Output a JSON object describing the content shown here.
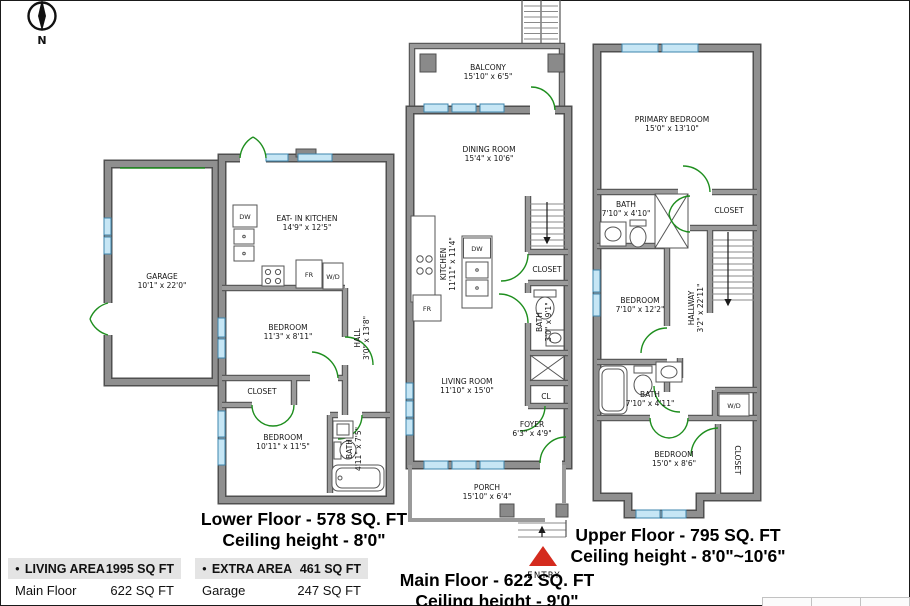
{
  "compass": {
    "label": "N"
  },
  "colors": {
    "wall": "#8f8f8f",
    "wall_edge": "#4f4f4f",
    "window": "#c6e6f5",
    "window_frame": "#3d85ad",
    "door": "#1e8e1e",
    "entry_marker": "#d42b1e",
    "table_header_bg": "#e4e4e4"
  },
  "floors": {
    "lower": {
      "caption1": "Lower Floor - 578 SQ. FT",
      "caption2": "Ceiling height - 8'0\"",
      "rooms": {
        "garage": {
          "name": "GARAGE",
          "dims": "10'1\" x 22'0\""
        },
        "kitchen": {
          "name": "EAT- IN KITCHEN",
          "dims": "14'9\" x 12'5\""
        },
        "bedroom1": {
          "name": "BEDROOM",
          "dims": "11'3\" x 8'11\""
        },
        "hall": {
          "name": "HALL",
          "dims": "3'0\" x 13'8\""
        },
        "closet": {
          "name": "CLOSET"
        },
        "bedroom2": {
          "name": "BEDROOM",
          "dims": "10'11\" x 11'5\""
        },
        "bath": {
          "name": "BATH",
          "dims": "4'11\" x 7'5\""
        }
      },
      "fixtures": {
        "dw": "DW",
        "fr": "FR",
        "wd": "W/D"
      }
    },
    "main": {
      "caption1": "Main Floor - 622 SQ. FT",
      "caption2": "Ceiling height - 9'0\"",
      "entry_label": "ENTRY",
      "rooms": {
        "balcony": {
          "name": "BALCONY",
          "dims": "15'10\" x 6'5\""
        },
        "dining": {
          "name": "DINING ROOM",
          "dims": "15'4\" x 10'6\""
        },
        "kitchen": {
          "name": "KITCHEN",
          "dims": "11'11\" x 11'4\""
        },
        "closet": {
          "name": "CLOSET"
        },
        "bath": {
          "name": "BATH",
          "dims": "3'0\" x 9'1\""
        },
        "cl": {
          "name": "CL"
        },
        "living": {
          "name": "LIVING ROOM",
          "dims": "11'10\" x 15'0\""
        },
        "foyer": {
          "name": "FOYER",
          "dims": "6'3\" x 4'9\""
        },
        "porch": {
          "name": "PORCH",
          "dims": "15'10\" x 6'4\""
        }
      },
      "fixtures": {
        "dw": "DW",
        "fr": "FR"
      }
    },
    "upper": {
      "caption1": "Upper Floor - 795 SQ. FT",
      "caption2": "Ceiling height - 8'0\"~10'6\"",
      "rooms": {
        "primary": {
          "name": "PRIMARY BEDROOM",
          "dims": "15'0\" x 13'10\""
        },
        "bath1": {
          "name": "BATH",
          "dims": "7'10\" x 4'10\""
        },
        "closet1": {
          "name": "CLOSET"
        },
        "bedroom1": {
          "name": "BEDROOM",
          "dims": "7'10\" x 12'2\""
        },
        "hallway": {
          "name": "HALLWAY",
          "dims": "3'2\" x 22'11\""
        },
        "bath2": {
          "name": "BATH",
          "dims": "7'10\" x 4'11\""
        },
        "bedroom2": {
          "name": "BEDROOM",
          "dims": "15'0\" x 8'6\""
        },
        "closet2": {
          "name": "CLOSET"
        }
      },
      "fixtures": {
        "wd": "W/D"
      }
    }
  },
  "legend": {
    "living": {
      "header_label": "LIVING AREA",
      "header_value": "1995 SQ FT",
      "bullet": "●",
      "rows": [
        {
          "name": "Main Floor",
          "value": "622 SQ FT"
        },
        {
          "name": "Upper Floor",
          "value": "795 SQ FT"
        }
      ]
    },
    "extra": {
      "header_label": "EXTRA AREA",
      "header_value": "461 SQ FT",
      "bullet": "●",
      "rows": [
        {
          "name": "Garage",
          "value": "247 SQ FT"
        },
        {
          "name": "Porch",
          "value": "96 SQ FT"
        }
      ]
    }
  }
}
